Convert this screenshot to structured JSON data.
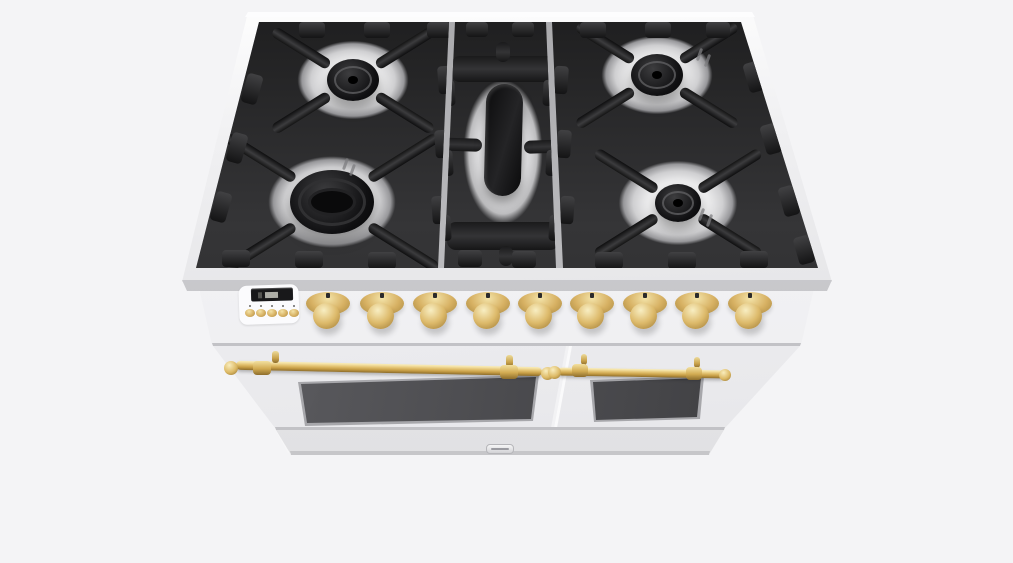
{
  "meta": {
    "description": "3D product render of a white freestanding dual-oven range cooker with a 5-burner gas cooktop, black cast-iron grates, brass control knobs, brass rail door handles and a storage drawer, viewed from above the front.",
    "background_color": "#f4f4f6"
  },
  "colors": {
    "body_white": "#f2f2f4",
    "steel_light": "#ececee",
    "grate_black": "#262628",
    "brass_base": "#d7b163",
    "brass_light": "#f3e3a8",
    "brass_dark": "#8d6d2c",
    "oven_glass": "#3f3f42"
  },
  "cooktop": {
    "grate_section_count": 3,
    "burner_count": 5,
    "burners": [
      {
        "id": "left-rear-burner",
        "section": "left",
        "shape": "round",
        "cx": 353,
        "cy": 80,
        "cap_w": 52,
        "cap_h": 42,
        "well_w": 150,
        "well_h": 106,
        "rings": 1,
        "prong_len": 66
      },
      {
        "id": "left-front-burner",
        "section": "left",
        "shape": "round",
        "cx": 332,
        "cy": 202,
        "cap_w": 84,
        "cap_h": 64,
        "well_w": 172,
        "well_h": 124,
        "rings": 3,
        "prong_len": 80
      },
      {
        "id": "right-rear-burner",
        "section": "right",
        "shape": "round",
        "cx": 657,
        "cy": 75,
        "cap_w": 52,
        "cap_h": 42,
        "well_w": 150,
        "well_h": 106,
        "rings": 1,
        "prong_len": 66
      },
      {
        "id": "right-front-burner",
        "section": "right",
        "shape": "round",
        "cx": 678,
        "cy": 203,
        "cap_w": 46,
        "cap_h": 38,
        "well_w": 160,
        "well_h": 114,
        "rings": 1,
        "prong_len": 72
      },
      {
        "id": "center-griddle-burner",
        "section": "center",
        "shape": "oval",
        "cx": 503,
        "cy": 140,
        "oval_w": 37,
        "oval_h": 112
      }
    ]
  },
  "control_panel": {
    "display": {
      "type": "digital-clock-display",
      "lit": true
    },
    "button_count": 5,
    "buttons_x": [
      245,
      256,
      267,
      278,
      289
    ],
    "buttons_y": 309,
    "knob_count": 9,
    "knobs_x": [
      330,
      384,
      437,
      490,
      542,
      594,
      647,
      699,
      752
    ],
    "knobs_y": 292
  },
  "ovens": {
    "left_door": {
      "window": true,
      "handle": "brass-rail"
    },
    "right_door": {
      "window": true,
      "handle": "brass-rail"
    }
  },
  "drawer": {
    "latch": true
  }
}
